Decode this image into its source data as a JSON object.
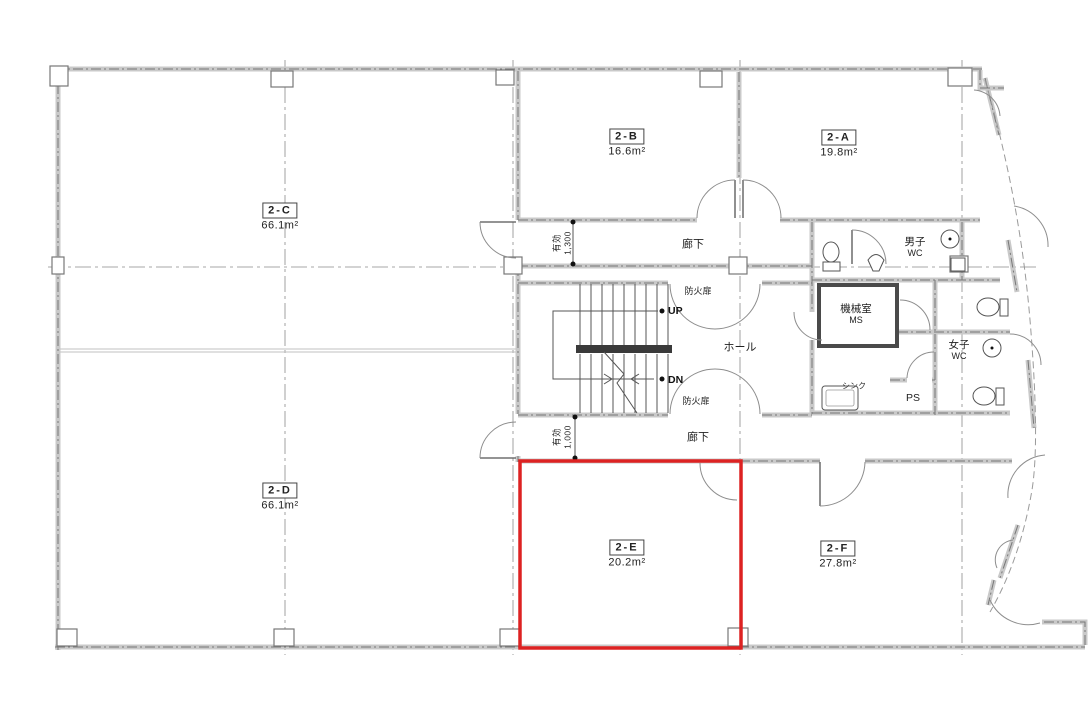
{
  "drawing": {
    "type": "architectural-floor-plan",
    "highlight_color": "#dd2222",
    "rooms": [
      {
        "tag": "2-C",
        "area": "66.1m²"
      },
      {
        "tag": "2-B",
        "area": "16.6m²"
      },
      {
        "tag": "2-A",
        "area": "19.8m²"
      },
      {
        "tag": "2-D",
        "area": "66.1m²"
      },
      {
        "tag": "2-E",
        "area": "20.2m²",
        "highlighted": true
      },
      {
        "tag": "2-F",
        "area": "27.8m²"
      }
    ],
    "labels": {
      "corridor_upper": "廊下",
      "corridor_lower": "廊下",
      "hall": "ホール",
      "fire_door_upper": "防火扉",
      "fire_door_lower": "防火扉",
      "stairs_up": "UP",
      "stairs_down": "DN",
      "mens_wc_line1": "男子",
      "mens_wc_line2": "WC",
      "womens_wc_line1": "女子",
      "womens_wc_line2": "WC",
      "machine_room_line1": "機械室",
      "machine_room_line2": "MS",
      "pipe_space": "PS",
      "sink": "シンク",
      "clear_width_upper_label": "有効",
      "clear_width_upper_value": "1,300",
      "clear_width_lower_label": "有効",
      "clear_width_lower_value": "1,000"
    }
  }
}
